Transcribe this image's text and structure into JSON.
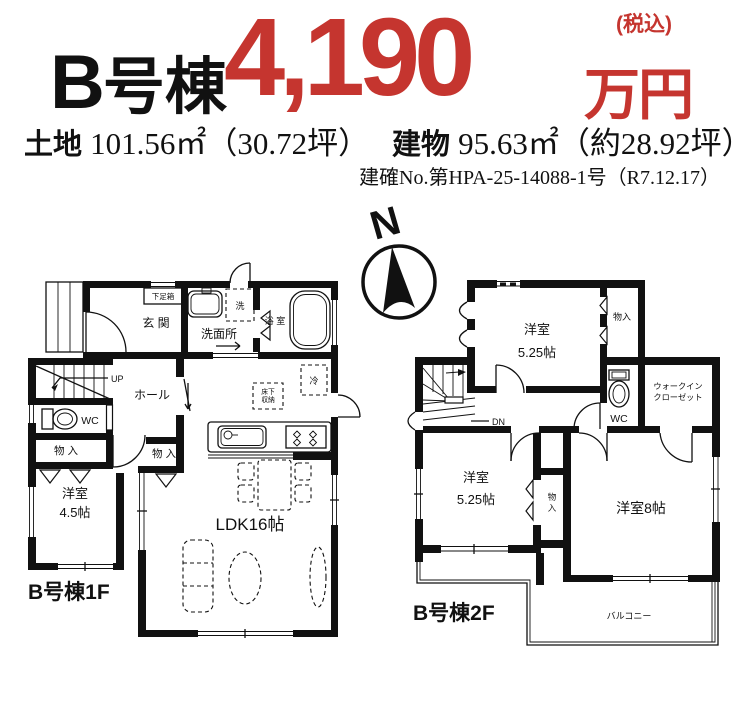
{
  "header": {
    "building": "号棟",
    "building_letter": "B",
    "price": "4,190",
    "unit": "万円",
    "tax": "(税込)",
    "land_label": "土地",
    "land_value": "101.56㎡（30.72坪）",
    "bldg_label": "建物",
    "bldg_value": "95.63㎡（約28.92坪）",
    "confirmation": "建確No.第HPA-25-14088-1号（R7.12.17）"
  },
  "compass": {
    "north": "N"
  },
  "floor1": {
    "caption": "B号棟1F",
    "labels": {
      "getabako": "下足箱",
      "genkan": "玄 関",
      "laundry": "洗",
      "washroom": "洗面所",
      "bath": "浴 室",
      "up": "UP",
      "hall": "ホール",
      "wc": "WC",
      "storage_left": "物 入",
      "storage_mid": "物 入",
      "room_name": "洋室",
      "room_size": "4.5帖",
      "ldk": "LDK16帖",
      "fridge": "冷",
      "underfloor1": "床下",
      "underfloor2": "収納"
    }
  },
  "floor2": {
    "caption": "B号棟2F",
    "labels": {
      "room_top_name": "洋室",
      "room_top_size": "5.25帖",
      "storage_top": "物入",
      "dn": "DN",
      "wc": "WC",
      "wic1": "ウォークイン",
      "wic2": "クローゼット",
      "room_left_name": "洋室",
      "room_left_size": "5.25帖",
      "storage_mid1": "物",
      "storage_mid2": "入",
      "room_right": "洋室8帖",
      "balcony": "バルコニー"
    }
  }
}
